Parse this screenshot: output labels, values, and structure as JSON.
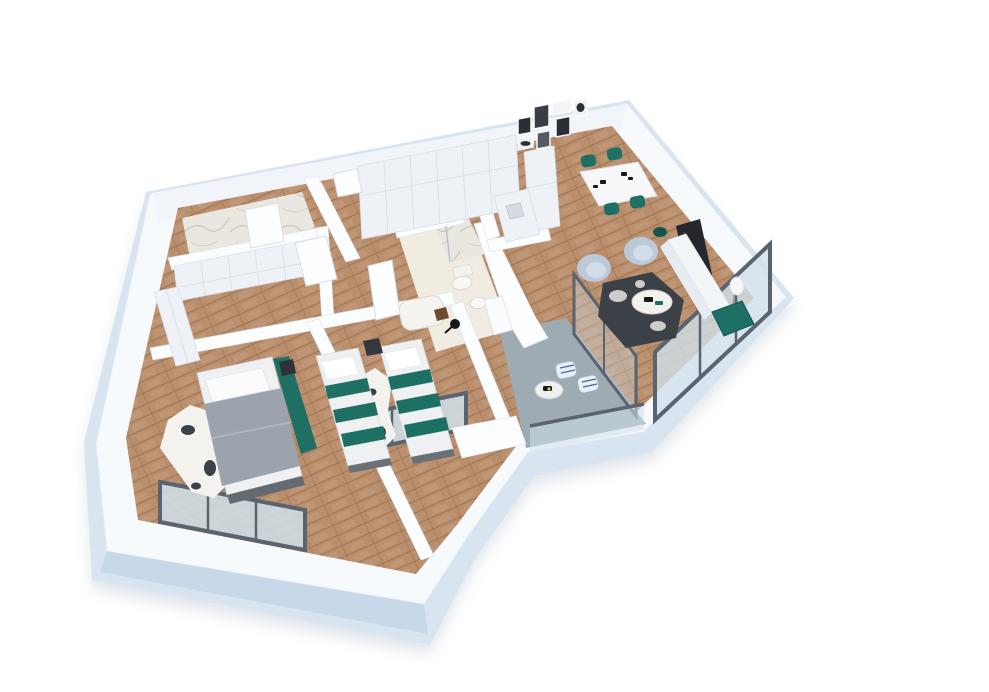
{
  "meta": {
    "alt": "3D isometric rendering of a two-bedroom apartment floor plan with kitchen, dining and living area, two bathrooms, walk-in wardrobe, hallway and balcony"
  },
  "palette": {
    "bg": "#ffffff",
    "shadow": "#b9c5d0",
    "wall_top": "#f7fafd",
    "wall_face": "#d8e5f1",
    "wall_face_shade": "#c7d8e8",
    "wall_inner": "#f1f5fa",
    "wall_white": "#fcfdff",
    "wood": "#b98f6e",
    "wood_dark": "#a0744f",
    "wood_light": "#cda687",
    "marble": "#eae7e0",
    "marble_vein": "#bfbbb0",
    "bath_floor": "#f0ece2",
    "balcony_floor": "#9fabb2",
    "teal": "#1e6f64",
    "teal_dark": "#14564e",
    "armchair_blue": "#bcc9d8",
    "armchair_blue_light": "#d3dde8",
    "rug_dark": "#3c4147",
    "rug_white": "#f3f2ef",
    "tv_black": "#24282e",
    "window_frame": "#5a6370",
    "glass": "#cfe0ea",
    "bed_gray": "#9ba3ac",
    "linen": "#eef0f1",
    "cabinet": "#eef2f7",
    "cabinet_line": "#d6dee7",
    "wood_item": "#6f4b2c",
    "black_item": "#17191c",
    "gallery_dark": "#2b2f35",
    "gallery_mid": "#565b62"
  }
}
